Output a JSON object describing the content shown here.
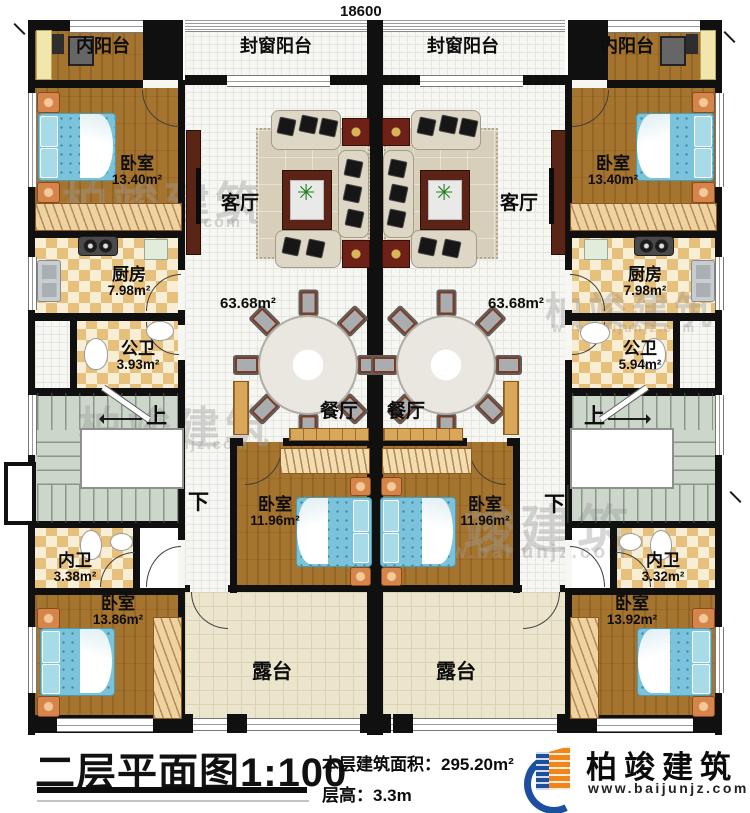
{
  "dimensions": {
    "top": "18600",
    "right": "18400"
  },
  "stairs": {
    "up": "上",
    "down": "下"
  },
  "rooms": {
    "inner_balcony": "内阳台",
    "sealed_balcony": "封窗阳台",
    "living": {
      "name": "客厅",
      "area": "63.68m²"
    },
    "dining": "餐厅",
    "kitchen": {
      "name": "厨房",
      "area": "7.98m²"
    },
    "public_bath_left": {
      "name": "公卫",
      "area": "3.93m²"
    },
    "public_bath_right": {
      "name": "公卫",
      "area": "5.94m²"
    },
    "bedroom_top": {
      "name": "卧室",
      "area": "13.40m²"
    },
    "bedroom_middle": {
      "name": "卧室",
      "area": "11.96m²"
    },
    "ensuite_left": {
      "name": "内卫",
      "area": "3.38m²"
    },
    "ensuite_right": {
      "name": "内卫",
      "area": "3.32m²"
    },
    "bedroom_bottom_left": {
      "name": "卧室",
      "area": "13.86m²"
    },
    "bedroom_bottom_right": {
      "name": "卧室",
      "area": "13.92m²"
    },
    "terrace": "露台"
  },
  "footer": {
    "title": "二层平面图1:100",
    "floor_area": "本层建筑面积：295.20m²",
    "floor_height": "层高：3.3m"
  },
  "logo": {
    "name": "柏竣建筑",
    "website": "www.baijunjz.com"
  },
  "watermark": {
    "text": "柏竣建筑",
    "website": "www.baijunjz.com"
  }
}
